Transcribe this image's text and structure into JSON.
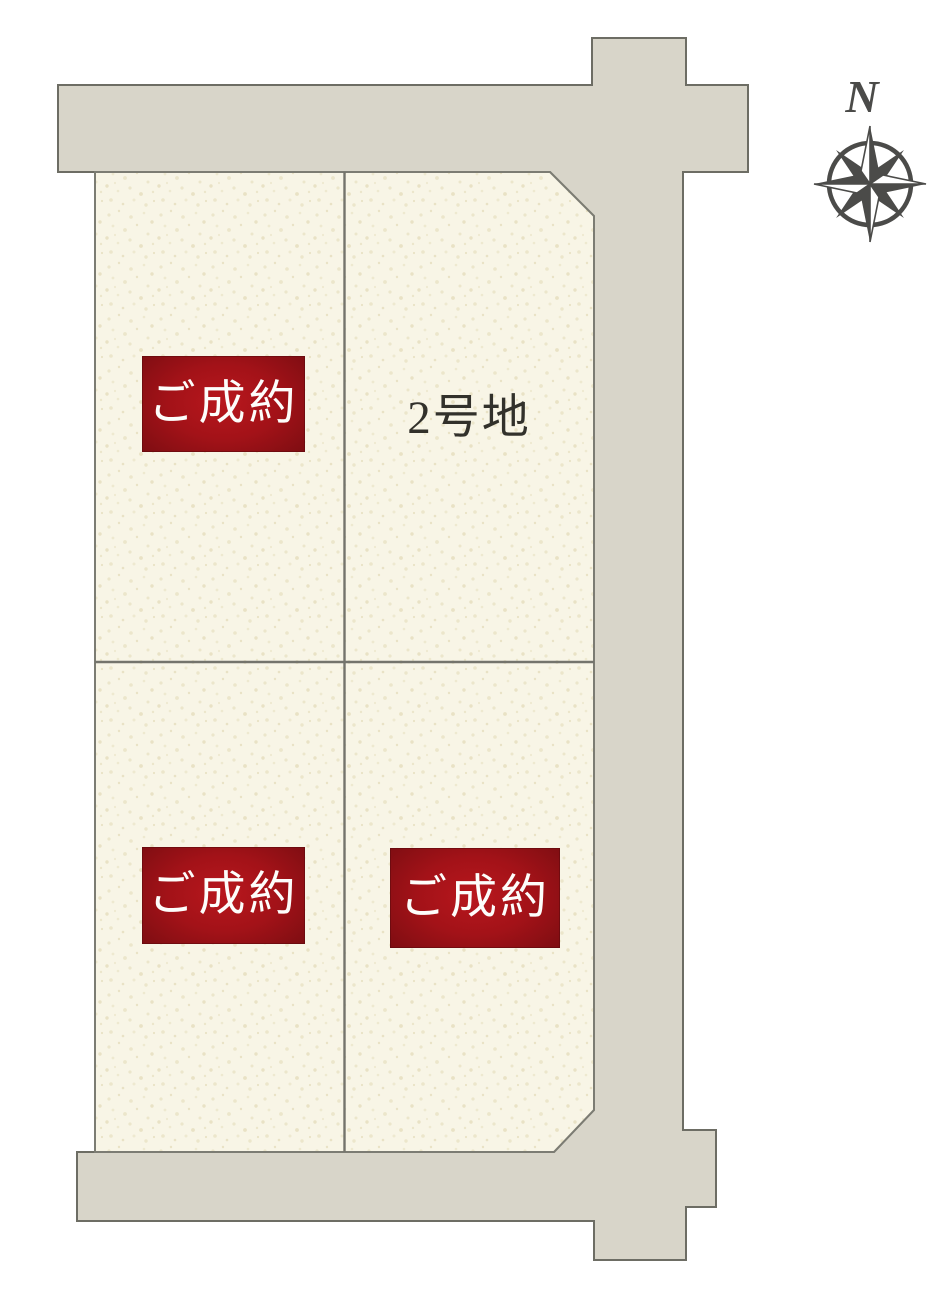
{
  "compass": {
    "north_label": "N",
    "icon_color": "#4b4b49"
  },
  "plan": {
    "colors": {
      "road_fill": "#d8d5c9",
      "road_stroke": "#6d6d64",
      "lot_fill": "#f8f5e6",
      "lot_speckle": "#ebe5ca",
      "boundary_stroke": "#7c7c73",
      "sold_badge_red": "#a31218",
      "badge_text": "#fdfdfb",
      "label_text": "#32312b"
    },
    "lots": [
      {
        "position": "top-left",
        "status": "sold",
        "badge": "ご成約"
      },
      {
        "position": "top-right",
        "status": "available",
        "label": "2号地"
      },
      {
        "position": "bottom-left",
        "status": "sold",
        "badge": "ご成約"
      },
      {
        "position": "bottom-right",
        "status": "sold",
        "badge": "ご成約"
      }
    ]
  }
}
